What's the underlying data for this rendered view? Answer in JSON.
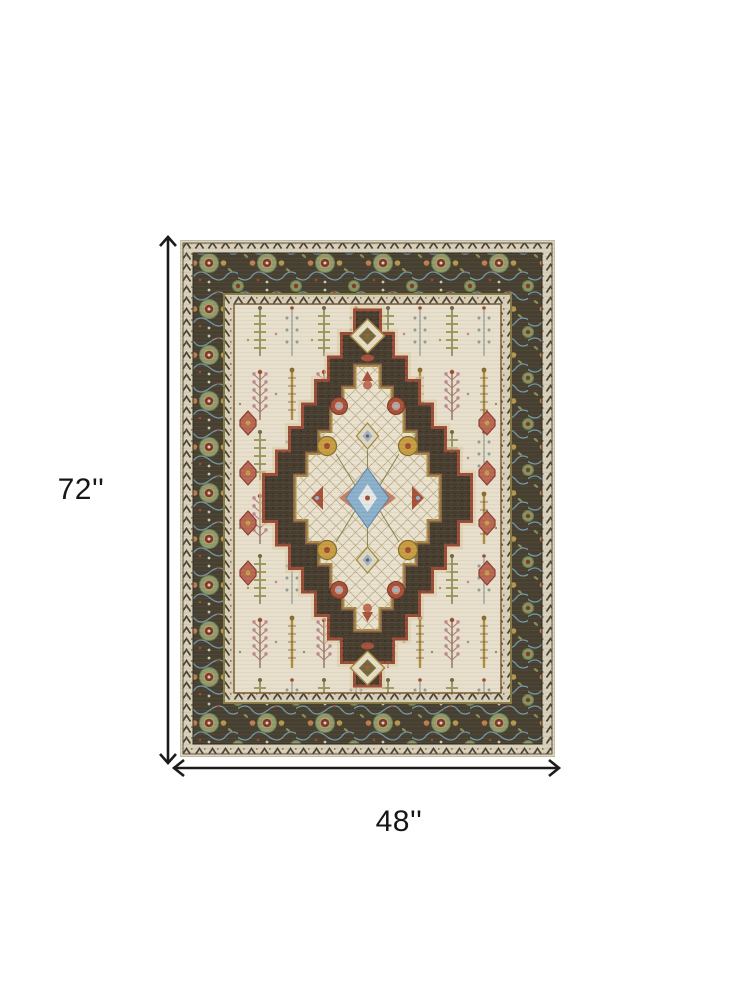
{
  "image": {
    "kind": "rug product photo with dimension annotations",
    "rug_palette": {
      "border_ground": "#474031",
      "guard_cream": "#d8d0b9",
      "field_ground": "#e7dfca",
      "medallion_ground": "#473d2f",
      "rust_outline": "#9c4b35",
      "accent_red": "#a34a33",
      "accent_blue": "#8ab0cd",
      "vine_blue": "#78a1b7",
      "accent_gold": "#c79d3d",
      "accent_olive": "#8f9b6b",
      "accent_pink": "#bb8591"
    }
  },
  "dimensions": {
    "height_label": "72''",
    "width_label": "48''",
    "arrow_color": "#1b1b1b",
    "label_color": "#161616"
  }
}
